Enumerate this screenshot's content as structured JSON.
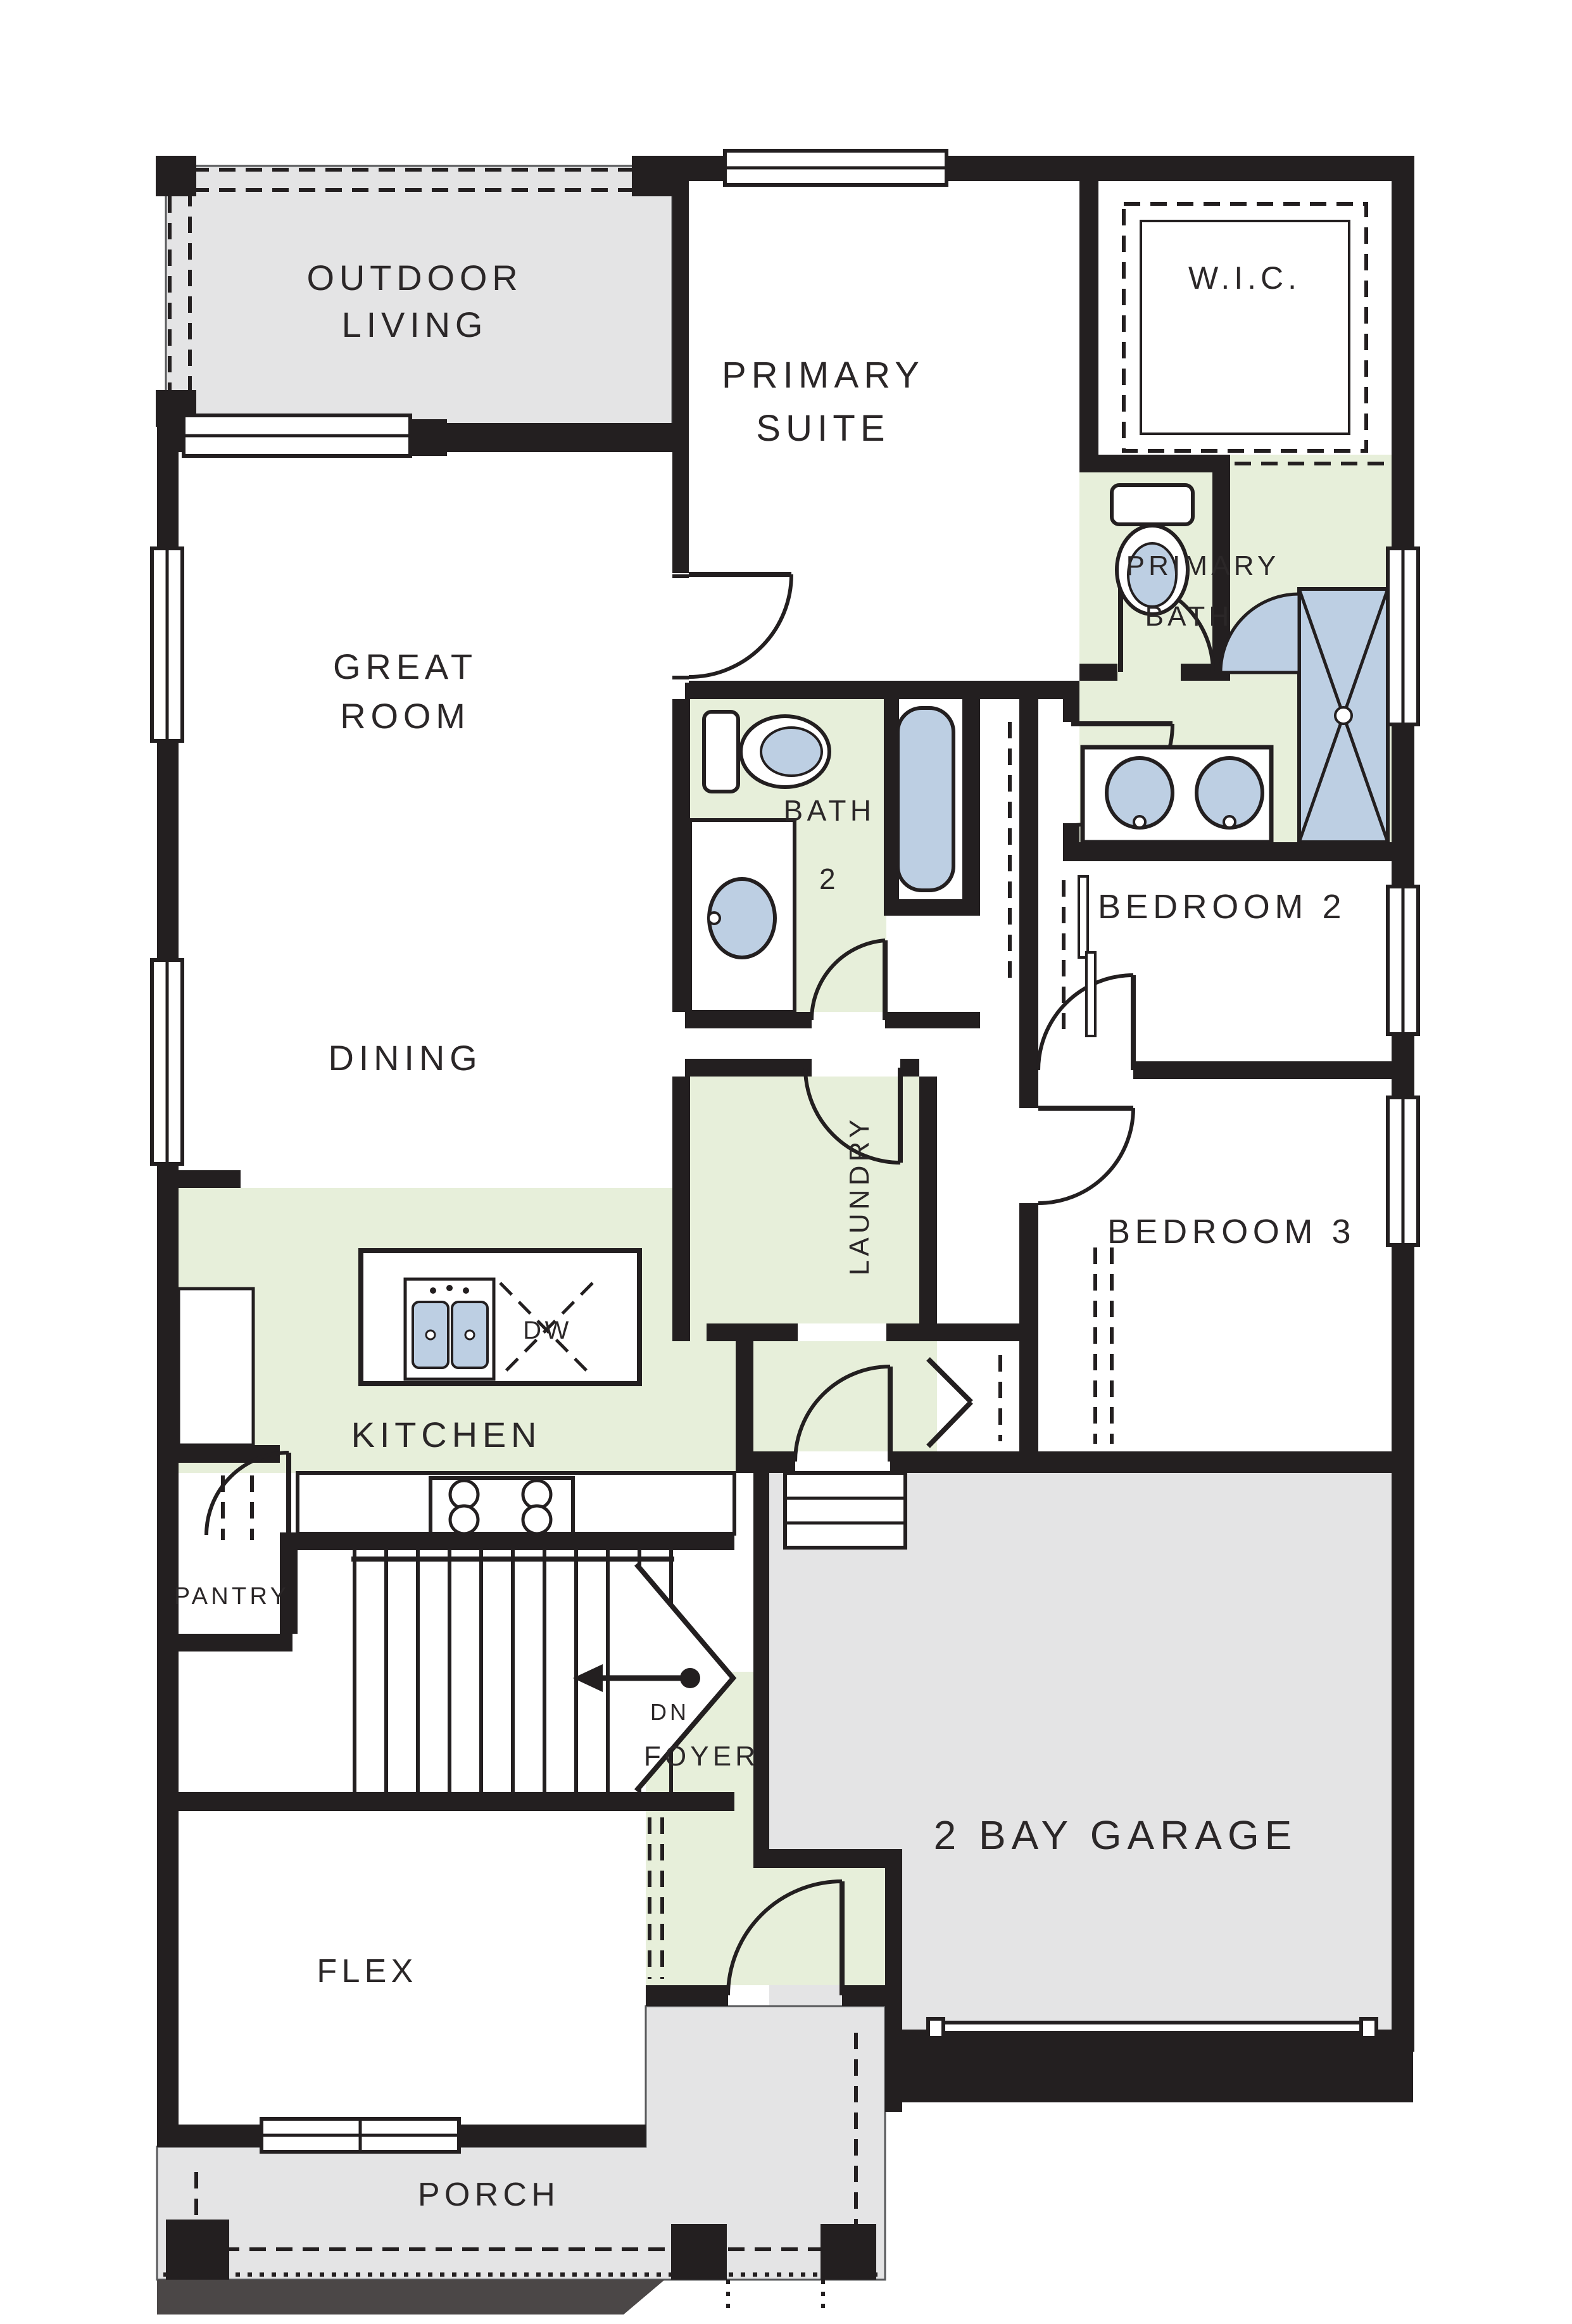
{
  "plan": {
    "colors": {
      "wall": "#231f20",
      "room_green": "#e7efda",
      "room_gray": "#e4e4e5",
      "fixture_blue": "#bdcfe3",
      "paper": "#ffffff",
      "text": "#2b2728"
    },
    "labels": {
      "outdoor_living": {
        "line1": "OUTDOOR",
        "line2": "LIVING"
      },
      "primary_suite": {
        "line1": "PRIMARY",
        "line2": "SUITE"
      },
      "wic": {
        "text": "W.I.C."
      },
      "primary_bath": {
        "line1": "PRIMARY",
        "line2": "BATH"
      },
      "great_room": {
        "line1": "GREAT",
        "line2": "ROOM"
      },
      "dining": {
        "text": "DINING"
      },
      "bath2": {
        "line1": "BATH",
        "line2": "2"
      },
      "bedroom2": {
        "text": "BEDROOM 2"
      },
      "bedroom3": {
        "text": "BEDROOM 3"
      },
      "laundry": {
        "text": "LAUNDRY"
      },
      "kitchen": {
        "text": "KITCHEN"
      },
      "pantry": {
        "text": "PANTRY"
      },
      "dishwasher": {
        "text": "DW"
      },
      "stairs_down": {
        "text": "DN"
      },
      "flex": {
        "text": "FLEX"
      },
      "foyer": {
        "text": "FOYER"
      },
      "garage": {
        "text": "2 BAY GARAGE"
      },
      "porch": {
        "text": "PORCH"
      }
    }
  }
}
